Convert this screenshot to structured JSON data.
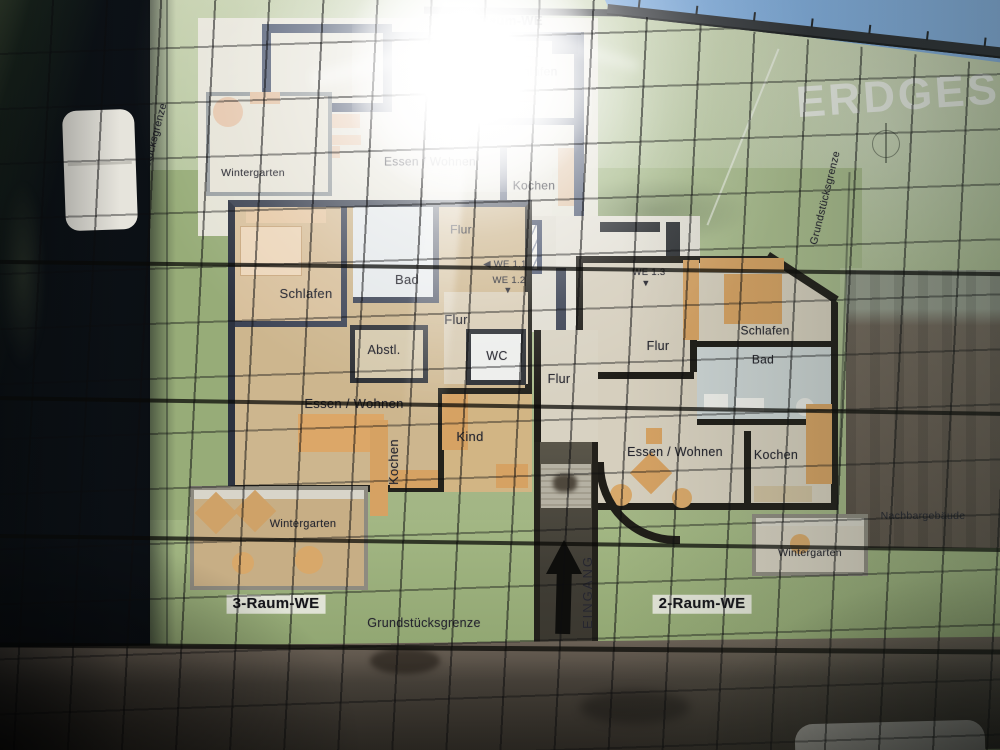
{
  "banner": {
    "title": "ERDGESC"
  },
  "floor_plan": {
    "apartment_types": [
      "2-Raum-WE",
      "3-Raum-WE"
    ],
    "unit_markers": [
      "WE 1.1",
      "WE 1.2",
      "WE 1.3"
    ],
    "labels": [
      {
        "id": "we2-top",
        "text": "2-Raum-WE",
        "x": 505,
        "y": 21,
        "size": 13,
        "bold": true
      },
      {
        "id": "bad-top",
        "text": "Bad",
        "x": 437,
        "y": 62,
        "size": 12
      },
      {
        "id": "schlafen-top",
        "text": "Schlafen",
        "x": 533,
        "y": 72,
        "size": 12
      },
      {
        "id": "wintergarten-top",
        "text": "Wintergarten",
        "x": 253,
        "y": 174,
        "size": 10.5
      },
      {
        "id": "essen-wohnen-top",
        "text": "Essen / Wohnen",
        "x": 430,
        "y": 162,
        "size": 12
      },
      {
        "id": "kochen-top",
        "text": "Kochen",
        "x": 534,
        "y": 186,
        "size": 12
      },
      {
        "id": "flur-top",
        "text": "Flur",
        "x": 461,
        "y": 230,
        "size": 12
      },
      {
        "id": "grenze-left",
        "text": "Grundstücksgrenze",
        "x": 152,
        "y": 150,
        "size": 10.5,
        "rot": -75
      },
      {
        "id": "grenze-right",
        "text": "Grundstücksgrenze",
        "x": 826,
        "y": 198,
        "size": 10.5,
        "rot": -76
      },
      {
        "id": "we-1-1",
        "text": "◀ WE 1.1",
        "x": 505,
        "y": 265,
        "size": 9.5
      },
      {
        "id": "we-1-2",
        "text": "WE 1.2",
        "x": 509,
        "y": 281,
        "size": 9.5
      },
      {
        "id": "we-1-2-arrow",
        "text": "▼",
        "x": 508,
        "y": 291,
        "size": 9
      },
      {
        "id": "we-1-3",
        "text": "WE 1.3",
        "x": 649,
        "y": 273,
        "size": 9.5
      },
      {
        "id": "we-1-3-arrow",
        "text": "▼",
        "x": 646,
        "y": 284,
        "size": 9
      },
      {
        "id": "schlafen-left",
        "text": "Schlafen",
        "x": 306,
        "y": 294,
        "size": 13
      },
      {
        "id": "bad-left",
        "text": "Bad",
        "x": 407,
        "y": 280,
        "size": 13
      },
      {
        "id": "flur-left",
        "text": "Flur",
        "x": 456,
        "y": 320,
        "size": 13
      },
      {
        "id": "abstellraum",
        "text": "Abstl.",
        "x": 384,
        "y": 351,
        "size": 12.5
      },
      {
        "id": "wc",
        "text": "WC",
        "x": 497,
        "y": 357,
        "size": 12.5
      },
      {
        "id": "essen-wohnen-left",
        "text": "Essen / Wohnen",
        "x": 354,
        "y": 404,
        "size": 13
      },
      {
        "id": "kochen-left",
        "text": "Kochen",
        "x": 394,
        "y": 462,
        "size": 13,
        "rot": -90
      },
      {
        "id": "kind",
        "text": "Kind",
        "x": 470,
        "y": 437,
        "size": 13
      },
      {
        "id": "wintergarten-left",
        "text": "Wintergarten",
        "x": 303,
        "y": 524,
        "size": 11
      },
      {
        "id": "flur-mitte",
        "text": "Flur",
        "x": 559,
        "y": 380,
        "size": 12.5
      },
      {
        "id": "flur-right",
        "text": "Flur",
        "x": 658,
        "y": 347,
        "size": 12.5
      },
      {
        "id": "schlafen-right",
        "text": "Schlafen",
        "x": 765,
        "y": 331,
        "size": 12
      },
      {
        "id": "bad-right",
        "text": "Bad",
        "x": 763,
        "y": 360,
        "size": 12
      },
      {
        "id": "essen-wohnen-right",
        "text": "Essen / Wohnen",
        "x": 675,
        "y": 453,
        "size": 12.5
      },
      {
        "id": "kochen-right",
        "text": "Kochen",
        "x": 776,
        "y": 456,
        "size": 12.5
      },
      {
        "id": "wintergarten-right",
        "text": "Wintergarten",
        "x": 810,
        "y": 554,
        "size": 10.5
      },
      {
        "id": "nachbargebaeude",
        "text": "Nachbargebäude",
        "x": 923,
        "y": 517,
        "size": 10.5
      },
      {
        "id": "we3-bottom",
        "text": "3-Raum-WE",
        "x": 276,
        "y": 604,
        "size": 15,
        "bold": true,
        "boxed": true
      },
      {
        "id": "grenze-bottom",
        "text": "Grundstücksgrenze",
        "x": 424,
        "y": 624,
        "size": 12.5
      },
      {
        "id": "we2-bottom",
        "text": "2-Raum-WE",
        "x": 702,
        "y": 604,
        "size": 15,
        "bold": true,
        "boxed": true
      },
      {
        "id": "eingang",
        "text": "EINGANG",
        "x": 588,
        "y": 592,
        "size": 13,
        "rot": -90,
        "ls": 2
      }
    ]
  },
  "colors": {
    "banner_green": "#b4c49d",
    "lawn_green": "#98ad79",
    "wall_dark": "#23221c",
    "wall_slate": "#4e5870",
    "floor_tan": "#cfb287",
    "furniture_orange": "#d6a263",
    "sky_blue": "#7fa9d4",
    "pavement": "#4a443c"
  }
}
